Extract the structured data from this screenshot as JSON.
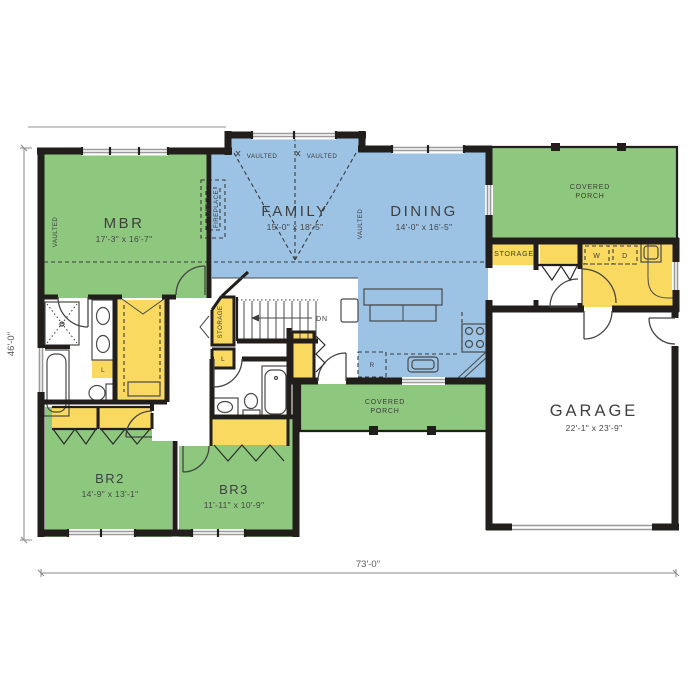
{
  "plan": {
    "rooms": {
      "mbr": {
        "name": "MBR",
        "dims": "17'-3\" x 16'-7\""
      },
      "family": {
        "name": "FAMILY",
        "dims": "15'-0\" x 18'-5\""
      },
      "dining": {
        "name": "DINING",
        "dims": "14'-0\" x 16'-5\""
      },
      "garage": {
        "name": "GARAGE",
        "dims": "22'-1\" x 23'-9\""
      },
      "br2": {
        "name": "BR2",
        "dims": "14'-9\" x 13'-1\""
      },
      "br3": {
        "name": "BR3",
        "dims": "11'-11\" x 10'-9\""
      }
    },
    "labels": {
      "covered": "COVERED",
      "porch": "PORCH",
      "storage": "STORAGE",
      "vaulted": "VAULTED",
      "opt_line1": "OPT.",
      "opt_line2": "FIREPLACE",
      "washer": "W",
      "dryer": "D",
      "fridge": "R",
      "linen": "L",
      "down": "DN"
    },
    "dimensions": {
      "overall_width": "73'-0\"",
      "overall_depth": "46'-0\""
    },
    "colors": {
      "bedroom_green": "#8dc87e",
      "living_blue": "#9cc2e4",
      "closet_yellow": "#f9d95f",
      "wall_black": "#211e1b"
    }
  }
}
